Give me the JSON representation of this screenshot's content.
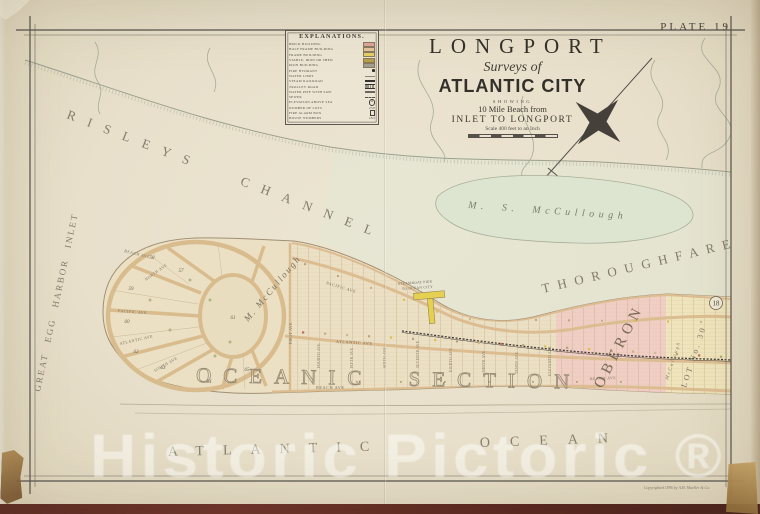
{
  "plate_label": "PLATE 19",
  "title": {
    "name": "LONGPORT",
    "surveys": "Surveys of",
    "city": "ATLANTIC CITY",
    "showing": "SHOWING",
    "beach_line": "10 Mile Beach from",
    "route_line": "INLET TO LONGPORT",
    "scale_line": "Scale 400 feet to an Inch"
  },
  "legend": {
    "title": "EXPLANATIONS.",
    "items": [
      {
        "label": "BRICK BUILDING",
        "color": "#dfa49c"
      },
      {
        "label": "HALF FRAME BUILDING",
        "color": "#e6c49c"
      },
      {
        "label": "FRAME BUILDING",
        "color": "#e2cf68"
      },
      {
        "label": "STABLE, IRON OR SHED",
        "color": "#b4a14e"
      },
      {
        "label": "IRON BUILDING",
        "color": "#a19e92"
      },
      {
        "label": "FIRE HYDRANT",
        "color": "#2e2c28"
      },
      {
        "label": "WATER LIMIT",
        "color": "#8a857a"
      },
      {
        "label": "STEAM RAILROAD",
        "color": "#343230"
      },
      {
        "label": "TROLLEY ROAD",
        "color": "#343230"
      },
      {
        "label": "WATER PIPE WITH SIZE",
        "color": "#6b675f"
      },
      {
        "label": "SEWER",
        "color": "#55504a"
      },
      {
        "label": "ELEVATION ABOVE SEA",
        "glyph": "10"
      },
      {
        "label": "NUMBER OF LOTS",
        "glyph": "2745"
      },
      {
        "label": "FIRE ALARM BOX",
        "glyph": ""
      },
      {
        "label": "HOUSE NUMBERS",
        "glyph": "1321"
      }
    ]
  },
  "waters": {
    "channel": "RISLEYS CHANNEL",
    "inlet": "GREAT EGG HARBOR INLET",
    "thoroughfare": "THOROUGHFARE",
    "ocean_left": "ATLANTIC",
    "ocean_right": "OCEAN",
    "pond_owner": "M. S. McCullough"
  },
  "island": {
    "section_label": "OCEANIC SECTION",
    "oberon": "OBERON",
    "lot_label": "LOT No. 30",
    "mccullough_side": "McCullough",
    "mccullough_tract": "M. McCullough",
    "plate_ref": "18",
    "pier_line1": "STEAMBOAT PIER",
    "pier_line2": "TO OCEAN CITY",
    "circle_streets": {
      "beach": "BEACH AVE",
      "north": "NORTH AVE",
      "pacific": "PACIFIC AVE",
      "atlantic": "ATLANTIC AVE",
      "south": "SOUTH AVE",
      "first": "FIRST AVE"
    },
    "grid_avenues": {
      "pacific": "PACIFIC AVE",
      "atlantic": "ATLANTIC AVE",
      "beach": "BEACH AVE",
      "beach_east": "BEACH AVE"
    },
    "vertical_streets": [
      "FOURTH AVE",
      "FIFTH AVE",
      "SIXTH AVE",
      "SEVENTH AVE",
      "EIGHTH AVE",
      "NINTH AVE",
      "TENTH AVE",
      "ELEVENTH AVE"
    ],
    "block_numbers": [
      "58",
      "57",
      "59",
      "60",
      "61",
      "62",
      "63",
      "64",
      "65"
    ]
  },
  "watermark": "Historic Pictoric ®",
  "copyright": "Copyrighted 1896 by A.H. Mueller & Co.",
  "colors": {
    "paper": "#e9e2cf",
    "oberon_pink": "#f2cac4",
    "lot_yellow": "#efe4ba",
    "pond_green": "#dde4cf",
    "road_tan": "#dcbd92",
    "backing_maroon": "#55231e"
  }
}
